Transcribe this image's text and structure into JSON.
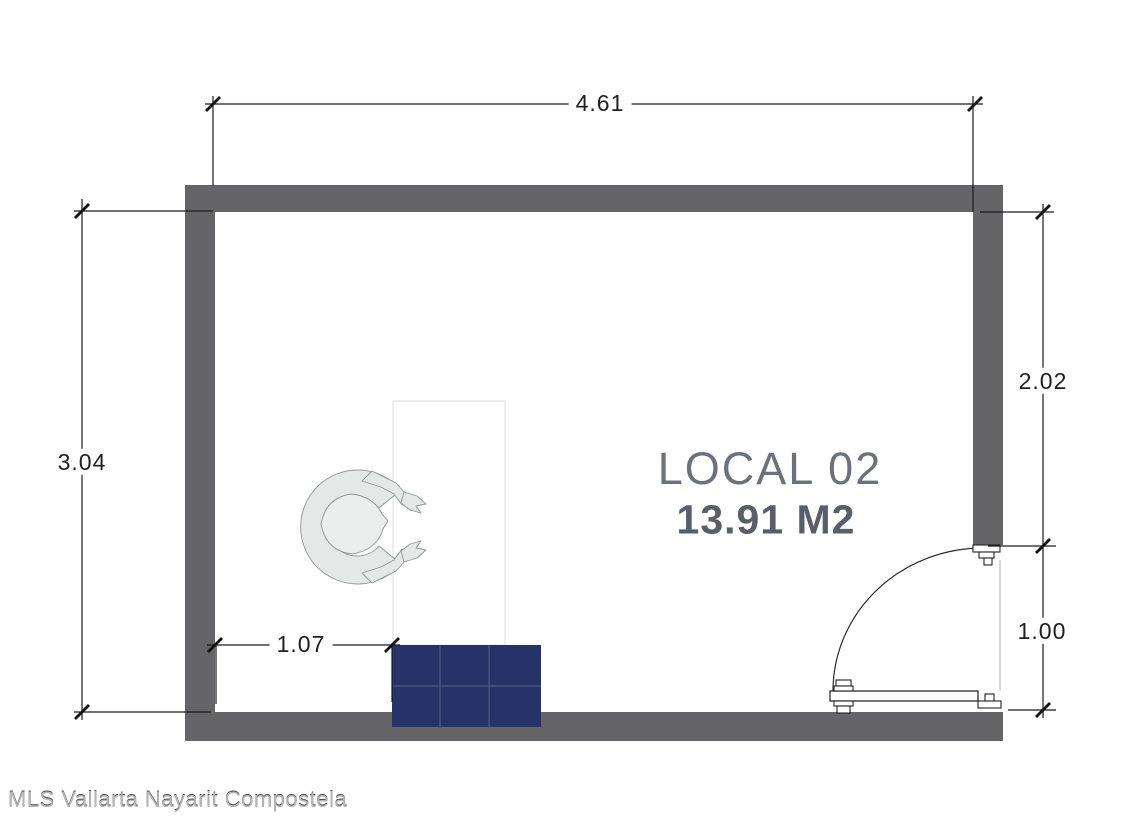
{
  "room": {
    "name": "LOCAL 02",
    "area": "13.91 M2"
  },
  "dimensions": {
    "top_width": "4.61",
    "left_height": "3.04",
    "right_upper_height": "2.02",
    "door_opening": "1.00",
    "counter_offset": "1.07"
  },
  "watermark": "MLS Vallarta Nayarit Compostela",
  "colors": {
    "wall": "#656568",
    "counter": "#263369",
    "counter_outline": "#dcdcdc",
    "room_label": "#6d727a",
    "area_label": "#595f68",
    "dimension_text": "#1f1f1f",
    "dimension_line": "#1c1c1c",
    "door_line": "#2b2b2b",
    "figure_fill": "#e6e8e7",
    "figure_head": "#eceeed",
    "figure_stroke": "#8f9693",
    "watermark_color": "#b5b5b5"
  }
}
